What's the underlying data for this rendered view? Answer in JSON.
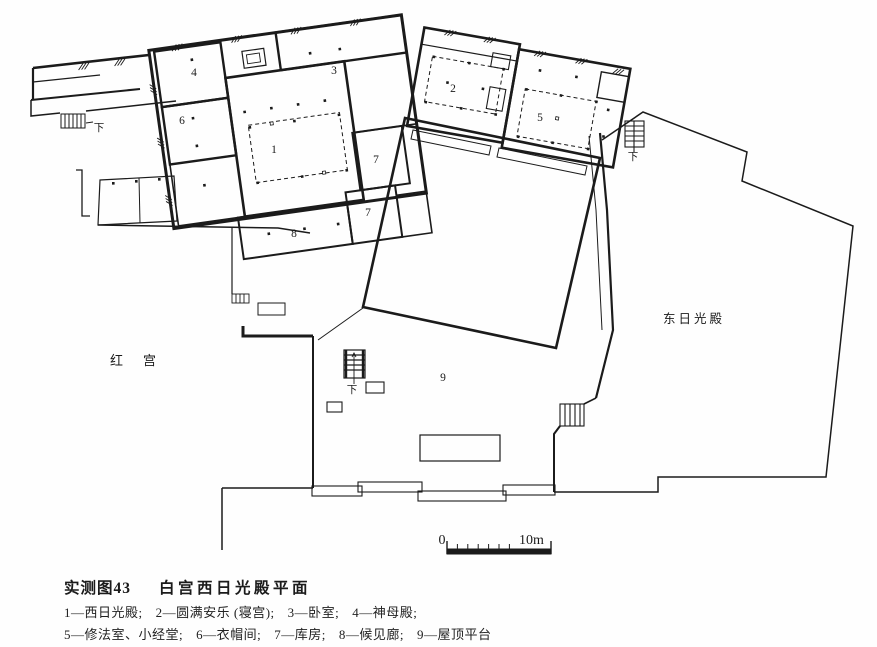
{
  "plan": {
    "rooms": [
      {
        "number": "1"
      },
      {
        "number": "2"
      },
      {
        "number": "3"
      },
      {
        "number": "4"
      },
      {
        "number": "5"
      },
      {
        "number": "6"
      },
      {
        "number": "7"
      },
      {
        "number": "7"
      },
      {
        "number": "8"
      },
      {
        "number": "9"
      }
    ],
    "stair_label": "下",
    "areas": {
      "red_palace": "红宫",
      "east_hall": "东日光殿"
    },
    "scale": {
      "start": "0",
      "end": "10m"
    }
  },
  "caption": {
    "figure_no": "实测图43",
    "title": "白宫西日光殿平面"
  },
  "legend": {
    "separator": "—",
    "terminator": ";",
    "rows": [
      [
        {
          "num": "1",
          "name": "西日光殿"
        },
        {
          "num": "2",
          "name": "圆满安乐 (寝宫)"
        },
        {
          "num": "3",
          "name": "卧室"
        },
        {
          "num": "4",
          "name": "神母殿"
        }
      ],
      [
        {
          "num": "5",
          "name": "修法室、小经堂"
        },
        {
          "num": "6",
          "name": "衣帽间"
        },
        {
          "num": "7",
          "name": "库房"
        },
        {
          "num": "8",
          "name": "候见廊"
        },
        {
          "num": "9",
          "name": "屋顶平台"
        }
      ]
    ]
  }
}
